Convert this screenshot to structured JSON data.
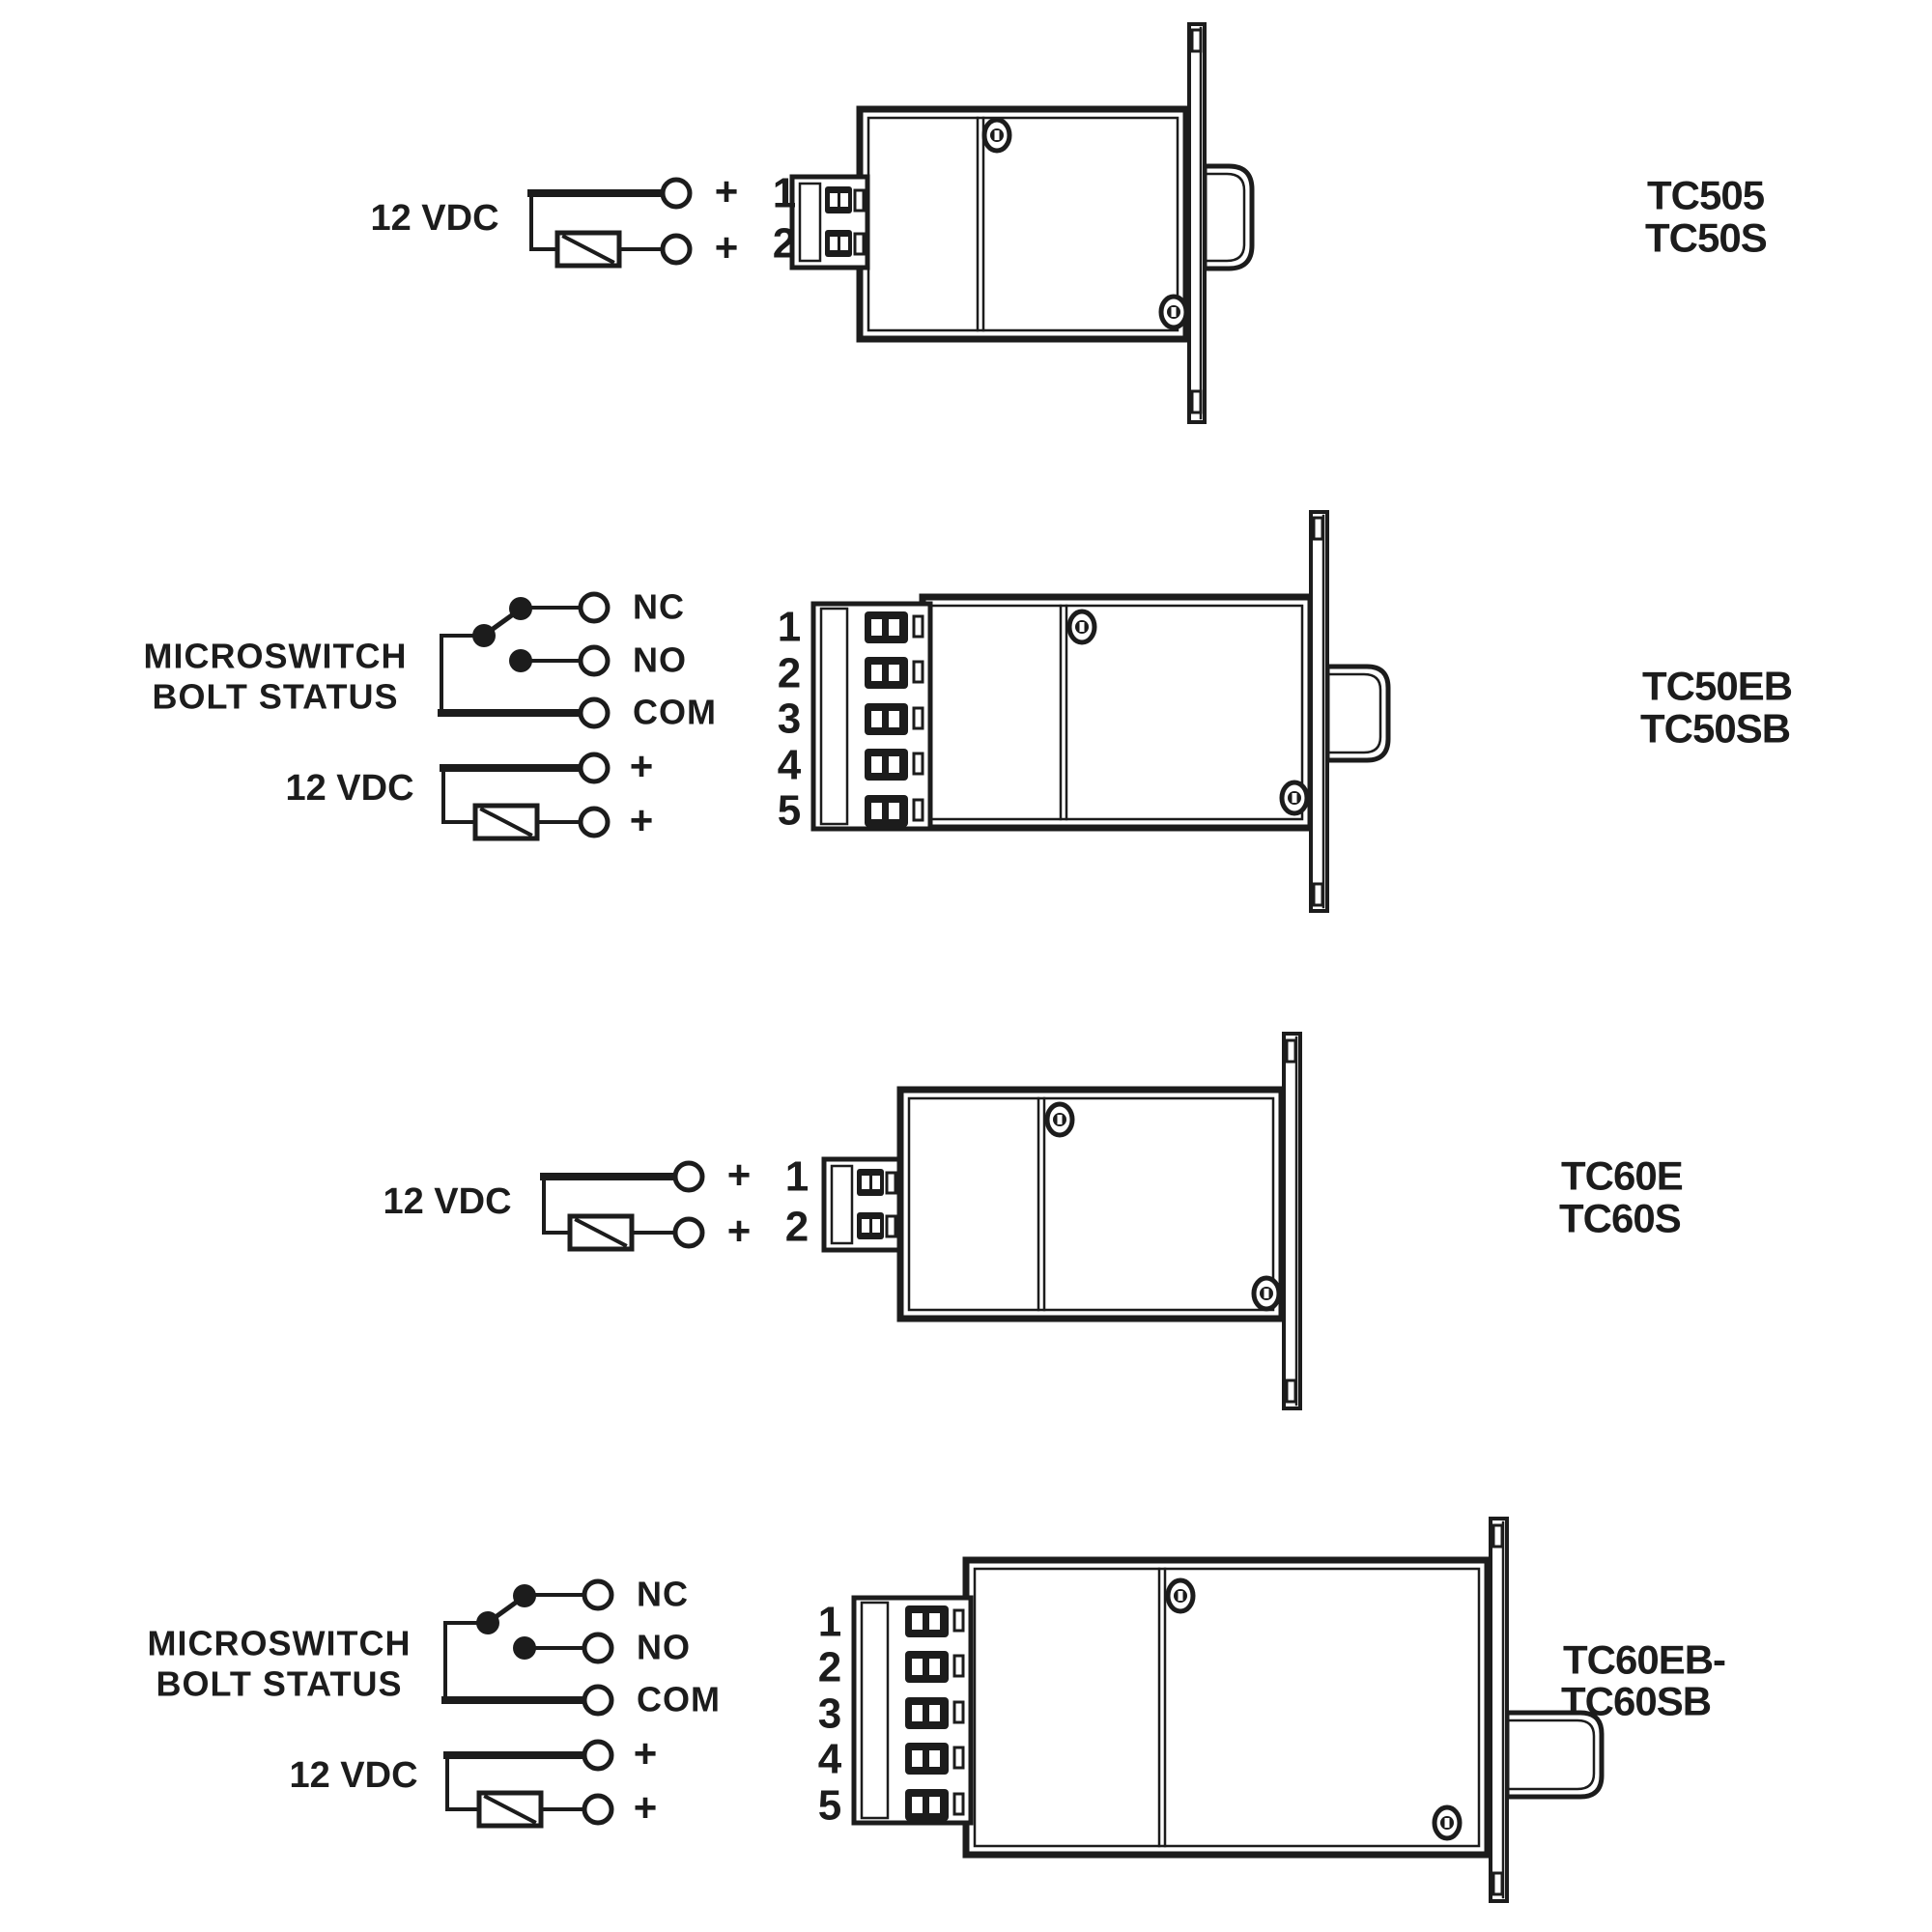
{
  "sheet": {
    "background": "#ffffff",
    "ink": "#1c1c1c"
  },
  "diagrams": [
    {
      "power_label": "12 VDC",
      "power_terminals": [
        "+",
        "+"
      ],
      "terminal_numbers": [
        "1",
        "2"
      ],
      "models": [
        "TC505",
        "TC50S"
      ]
    },
    {
      "microswitch_label_line1": "MICROSWITCH",
      "microswitch_label_line2": "BOLT STATUS",
      "switch_terminals": [
        "NC",
        "NO",
        "COM"
      ],
      "power_label": "12 VDC",
      "power_terminals": [
        "+",
        "+"
      ],
      "terminal_numbers": [
        "1",
        "2",
        "3",
        "4",
        "5"
      ],
      "models": [
        "TC50EB",
        "TC50SB"
      ]
    },
    {
      "power_label": "12 VDC",
      "power_terminals": [
        "+",
        "+"
      ],
      "terminal_numbers": [
        "1",
        "2"
      ],
      "models": [
        "TC60E",
        "TC60S"
      ]
    },
    {
      "microswitch_label_line1": "MICROSWITCH",
      "microswitch_label_line2": "BOLT STATUS",
      "switch_terminals": [
        "NC",
        "NO",
        "COM"
      ],
      "power_label": "12 VDC",
      "power_terminals": [
        "+",
        "+"
      ],
      "terminal_numbers": [
        "1",
        "2",
        "3",
        "4",
        "5"
      ],
      "models": [
        "TC60EB-",
        "TC60SB"
      ]
    }
  ]
}
